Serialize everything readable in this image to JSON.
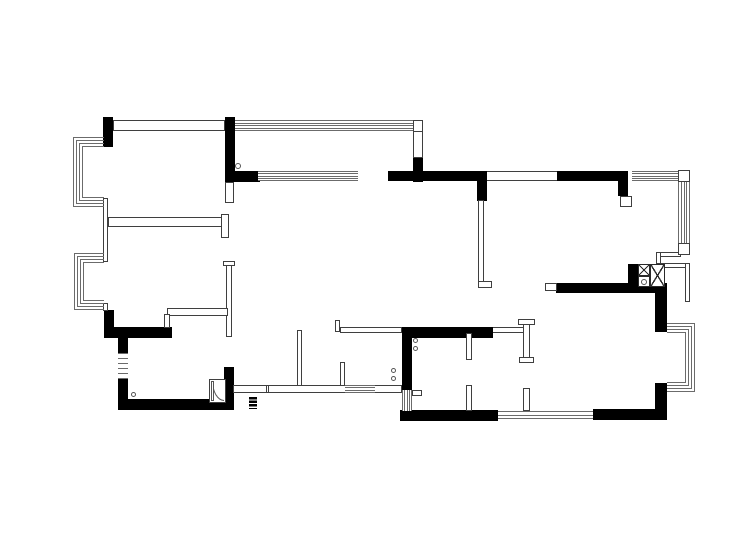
{
  "meta": {
    "document_type": "residential-floor-plan-drawing",
    "canvas_width": 750,
    "canvas_height": 541,
    "background_color": "#ffffff",
    "wall_fill_color": "#000000",
    "thin_line_color": "#3f3f3f",
    "window_line_color": "#6b6b6b"
  },
  "elements": {
    "solid_walls": [
      {
        "id": "wall-top-left-corner",
        "r": [
          103,
          117,
          10,
          30
        ]
      },
      {
        "id": "wall-bedroom1-right",
        "r": [
          225,
          117,
          10,
          65
        ]
      },
      {
        "id": "wall-balcony-sill-left",
        "r": [
          235,
          171,
          25,
          11
        ]
      },
      {
        "id": "wall-balcony-right-lower",
        "r": [
          413,
          157,
          10,
          25
        ]
      },
      {
        "id": "wall-living-top",
        "r": [
          388,
          171,
          99,
          10
        ]
      },
      {
        "id": "wall-living-top-stub",
        "r": [
          477,
          181,
          10,
          20
        ]
      },
      {
        "id": "wall-top-right",
        "r": [
          557,
          171,
          71,
          10
        ]
      },
      {
        "id": "wall-top-right-stub",
        "r": [
          618,
          181,
          10,
          15
        ]
      },
      {
        "id": "wall-shaft-left",
        "r": [
          628,
          264,
          10,
          23
        ]
      },
      {
        "id": "wall-east-room-top",
        "r": [
          556,
          283,
          111,
          10
        ]
      },
      {
        "id": "wall-right-above-bay",
        "r": [
          655,
          283,
          12,
          49
        ]
      },
      {
        "id": "wall-right-below-bay",
        "r": [
          655,
          383,
          12,
          37
        ]
      },
      {
        "id": "wall-bottom-right",
        "r": [
          593,
          409,
          74,
          11
        ]
      },
      {
        "id": "wall-kitchen-bottom",
        "r": [
          400,
          410,
          98,
          11
        ]
      },
      {
        "id": "wall-kitchen-left",
        "r": [
          402,
          327,
          10,
          63
        ]
      },
      {
        "id": "wall-kitchen-top",
        "r": [
          402,
          327,
          91,
          11
        ]
      },
      {
        "id": "wall-left-below-bay2",
        "r": [
          104,
          310,
          10,
          28
        ]
      },
      {
        "id": "wall-bath-top",
        "r": [
          104,
          327,
          68,
          11
        ]
      },
      {
        "id": "wall-bath-left-upper",
        "r": [
          118,
          338,
          10,
          15
        ]
      },
      {
        "id": "wall-bath-left-lower",
        "r": [
          118,
          379,
          10,
          31
        ]
      },
      {
        "id": "wall-bath-bottom",
        "r": [
          118,
          399,
          116,
          11
        ]
      },
      {
        "id": "wall-bath-right",
        "r": [
          224,
          367,
          10,
          43
        ]
      }
    ],
    "hollow_walls": [
      {
        "id": "wall-bedroom1-top",
        "r": [
          113,
          120,
          112,
          11
        ]
      },
      {
        "id": "wall-left-mid",
        "r": [
          103,
          198,
          5,
          64
        ]
      },
      {
        "id": "wall-left-low",
        "r": [
          103,
          303,
          5,
          8
        ]
      },
      {
        "id": "wall-bedrooms-divider",
        "r": [
          108,
          217,
          114,
          10
        ]
      },
      {
        "id": "wall-bedrooms-divider-cap",
        "r": [
          221,
          214,
          8,
          24
        ]
      },
      {
        "id": "wall-bedroom2-right",
        "r": [
          226,
          262,
          6,
          75
        ]
      },
      {
        "id": "wall-bedroom2-right-cap",
        "r": [
          223,
          261,
          12,
          5
        ]
      },
      {
        "id": "wall-bedroom2-south",
        "r": [
          167,
          308,
          61,
          8
        ]
      },
      {
        "id": "wall-bedroom2-south-leg",
        "r": [
          164,
          314,
          6,
          14
        ]
      },
      {
        "id": "wall-balcony-right-upper",
        "r": [
          413,
          120,
          10,
          38
        ]
      },
      {
        "id": "wall-rightrooms-divider",
        "r": [
          478,
          200,
          6,
          87
        ]
      },
      {
        "id": "wall-rightrooms-divider-foot",
        "r": [
          478,
          281,
          14,
          7
        ]
      },
      {
        "id": "wall-closet-left",
        "r": [
          466,
          333,
          6,
          27
        ]
      },
      {
        "id": "wall-closet-left-stub",
        "r": [
          466,
          385,
          6,
          26
        ]
      },
      {
        "id": "wall-closet-right",
        "r": [
          523,
          320,
          7,
          42
        ]
      },
      {
        "id": "wall-closet-right-cap",
        "r": [
          518,
          319,
          17,
          6
        ]
      },
      {
        "id": "wall-closet-right-cap2",
        "r": [
          519,
          357,
          15,
          6
        ]
      },
      {
        "id": "wall-closet-right-stub",
        "r": [
          523,
          388,
          7,
          23
        ]
      },
      {
        "id": "wall-hall-tick",
        "r": [
          335,
          320,
          5,
          12
        ]
      },
      {
        "id": "wall-hall-south",
        "r": [
          340,
          327,
          62,
          6
        ]
      },
      {
        "id": "wall-hall-partition1",
        "r": [
          297,
          330,
          5,
          58
        ]
      },
      {
        "id": "wall-hall-partition2",
        "r": [
          340,
          362,
          5,
          26
        ]
      },
      {
        "id": "wall-south-parapet",
        "r": [
          233,
          385,
          169,
          8
        ]
      },
      {
        "id": "wall-south-parapet-tick",
        "r": [
          266,
          385,
          3,
          8
        ]
      },
      {
        "id": "wall-south-link",
        "r": [
          412,
          390,
          10,
          6
        ]
      },
      {
        "id": "wall-top-right-jamb",
        "r": [
          620,
          196,
          12,
          11
        ]
      },
      {
        "id": "wall-bedroom1-jamb",
        "r": [
          225,
          182,
          9,
          21
        ]
      },
      {
        "id": "wall-step-1",
        "r": [
          656,
          252,
          25,
          5
        ]
      },
      {
        "id": "wall-step-2",
        "r": [
          656,
          252,
          5,
          16
        ]
      },
      {
        "id": "wall-step-3",
        "r": [
          656,
          263,
          34,
          5
        ]
      },
      {
        "id": "wall-step-4",
        "r": [
          685,
          263,
          5,
          39
        ]
      },
      {
        "id": "wall-stub-left-of-east-top",
        "r": [
          545,
          283,
          12,
          8
        ]
      }
    ],
    "openings": [
      {
        "id": "opening-top-right",
        "r": [
          487,
          171,
          70,
          10
        ]
      },
      {
        "id": "opening-kitchen-lintel",
        "r": [
          493,
          327,
          30,
          6
        ]
      }
    ],
    "windows": [
      {
        "id": "window-balcony-north",
        "r": [
          235,
          120,
          178,
          11
        ],
        "dir": "h",
        "n": 5
      },
      {
        "id": "window-balcony-inner",
        "r": [
          258,
          171,
          100,
          10
        ],
        "dir": "h",
        "n": 5
      },
      {
        "id": "window-northeast",
        "r": [
          632,
          171,
          46,
          10
        ],
        "dir": "h",
        "n": 5
      },
      {
        "id": "window-east-upper",
        "r": [
          678,
          182,
          12,
          61
        ],
        "dir": "v",
        "n": 5
      },
      {
        "id": "window-bath-west",
        "r": [
          118,
          353,
          10,
          26
        ],
        "dir": "h",
        "n": 6
      },
      {
        "id": "window-south-small",
        "r": [
          345,
          385,
          30,
          8
        ],
        "dir": "h",
        "n": 4
      },
      {
        "id": "window-kitchen-west",
        "r": [
          402,
          390,
          10,
          21
        ],
        "dir": "v",
        "n": 5
      },
      {
        "id": "window-south-bedroom",
        "r": [
          498,
          411,
          95,
          8
        ],
        "dir": "h",
        "n": 3
      }
    ],
    "boxes": [
      {
        "id": "box-balcony-corner",
        "r": [
          413,
          120,
          10,
          12
        ]
      },
      {
        "id": "box-window-corner-ne",
        "r": [
          678,
          170,
          12,
          12
        ]
      },
      {
        "id": "box-window-end-east",
        "r": [
          678,
          243,
          12,
          12
        ]
      }
    ],
    "bay_windows": [
      {
        "id": "bay-window-northwest",
        "r": [
          73,
          137,
          31,
          70
        ],
        "open": "right",
        "panes": 4
      },
      {
        "id": "bay-window-west",
        "r": [
          74,
          253,
          30,
          57
        ],
        "open": "right",
        "panes": 4
      },
      {
        "id": "bay-window-east",
        "r": [
          667,
          323,
          28,
          69
        ],
        "open": "left",
        "panes": 4
      }
    ],
    "flue_shaft": [
      {
        "id": "flue-box-small",
        "r": [
          638,
          264,
          12,
          12
        ],
        "glyph": "x"
      },
      {
        "id": "flue-box-meter",
        "r": [
          638,
          276,
          12,
          11
        ],
        "glyph": "o"
      },
      {
        "id": "flue-box-large",
        "r": [
          650,
          264,
          15,
          23
        ],
        "glyph": "x"
      }
    ],
    "door": {
      "id": "door-bath",
      "frame": [
        209,
        379,
        17,
        24
      ],
      "arc": [
        212,
        381,
        12,
        20
      ]
    },
    "circles": [
      {
        "id": "pivot-marker-balcony",
        "c": [
          238,
          166
        ],
        "d": 6
      },
      {
        "id": "pivot-marker-bath",
        "c": [
          133,
          394
        ],
        "d": 5
      },
      {
        "id": "fixture-marker-hall-1",
        "c": [
          393,
          370
        ],
        "d": 5
      },
      {
        "id": "fixture-marker-hall-2",
        "c": [
          393,
          378
        ],
        "d": 5
      },
      {
        "id": "fixture-marker-kitchen-1",
        "c": [
          415,
          340
        ],
        "d": 5
      },
      {
        "id": "fixture-marker-kitchen-2",
        "c": [
          415,
          348
        ],
        "d": 5
      }
    ],
    "section_marker": {
      "id": "section-marker",
      "r": [
        249,
        397,
        8,
        12
      ]
    }
  }
}
